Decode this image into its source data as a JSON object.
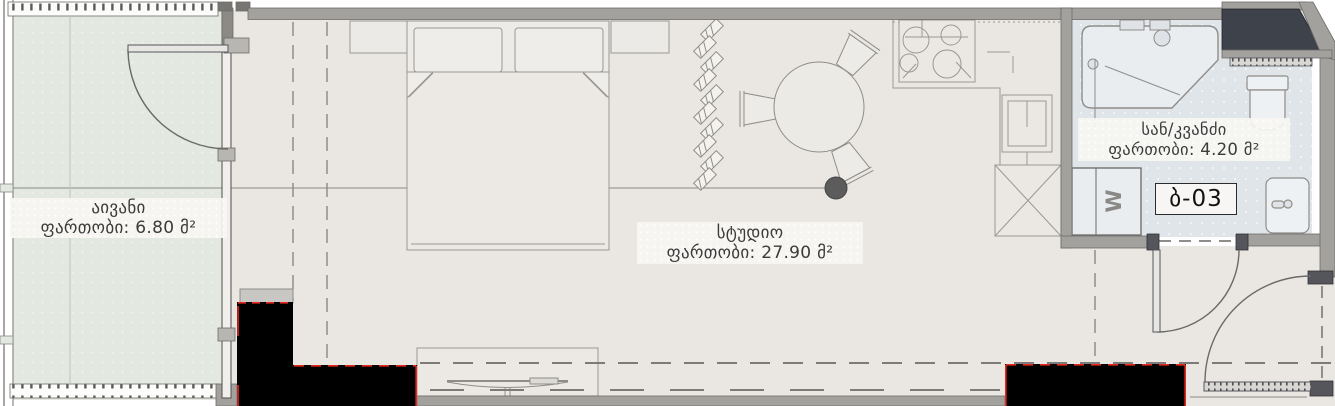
{
  "plan": {
    "title": "apartment-floor-plan",
    "rooms": {
      "balcony": {
        "name": "აივანი",
        "area_label": "ფართობი: 6.80 მ²"
      },
      "studio": {
        "name": "სტუდიო",
        "area_label": "ფართობი: 27.90 მ²"
      },
      "bathroom": {
        "name": "სან/კვანძი",
        "area_label": "ფართობი: 4.20 მ²"
      }
    },
    "unit_tag": {
      "label": "ბ-03"
    },
    "appliances": {
      "washer_label": "W"
    },
    "furniture_icons": [
      "double-bed",
      "nightstand",
      "coat-rack-hooks",
      "round-dining-table",
      "dining-chair",
      "potted-plant",
      "tv-stand",
      "tv",
      "stove-4-burners",
      "kitchen-sink",
      "shaft-x-box",
      "shower",
      "toilet",
      "washing-machine",
      "bathroom-sink"
    ],
    "colors": {
      "floor_studio": "#eae7e2",
      "floor_balcony": "#e3e8e0",
      "floor_bathroom": "#dfe5e9",
      "wall_gray": "#a3a19e",
      "jamb_dark": "#55565c",
      "shaft_dark": "#3e424a",
      "column_black": "#000000",
      "accent_red": "#e8281e",
      "outline": "#8f8d89",
      "text": "#3b3b3b"
    }
  }
}
